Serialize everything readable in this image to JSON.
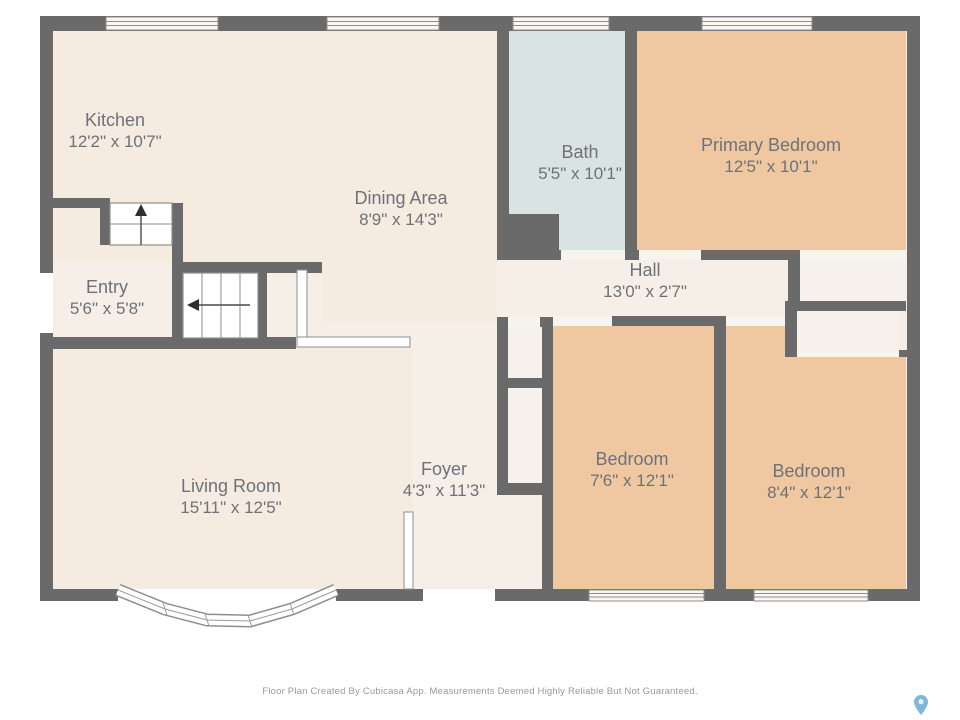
{
  "title": "Floor Plan",
  "rooms": [
    {
      "id": "kitchen",
      "name": "Kitchen",
      "dims": "12'2\" x 10'7\""
    },
    {
      "id": "dining",
      "name": "Dining Area",
      "dims": "8'9\" x 14'3\""
    },
    {
      "id": "bath",
      "name": "Bath",
      "dims": "5'5\" x 10'1\""
    },
    {
      "id": "primary-bedroom",
      "name": "Primary Bedroom",
      "dims": "12'5\" x 10'1\""
    },
    {
      "id": "entry",
      "name": "Entry",
      "dims": "5'6\" x 5'8\""
    },
    {
      "id": "hall",
      "name": "Hall",
      "dims": "13'0\" x 2'7\""
    },
    {
      "id": "living-room",
      "name": "Living Room",
      "dims": "15'11\" x 12'5\""
    },
    {
      "id": "foyer",
      "name": "Foyer",
      "dims": "4'3\" x 11'3\""
    },
    {
      "id": "bedroom-1",
      "name": "Bedroom",
      "dims": "7'6\" x 12'1\""
    },
    {
      "id": "bedroom-2",
      "name": "Bedroom",
      "dims": "8'4\" x 12'1\""
    }
  ],
  "footer": "Floor Plan Created By Cubicasa App. Measurements Deemed Highly Reliable But Not Guaranteed.",
  "icons": {
    "location_pin": "location-pin-icon"
  },
  "colors": {
    "wall": "#6a6a6a",
    "floor_main": "#f6ebe1",
    "floor_light": "#f5efe8",
    "floor_closet": "#f6f1ec",
    "bath_floor": "#d8e3e2",
    "bedroom_floor": "#efc8a2",
    "window_outline": "#8e8e8e",
    "label_text": "#6d7278",
    "footer_text": "#97999c",
    "pin_blue": "#7db7da",
    "background": "#ffffff"
  }
}
